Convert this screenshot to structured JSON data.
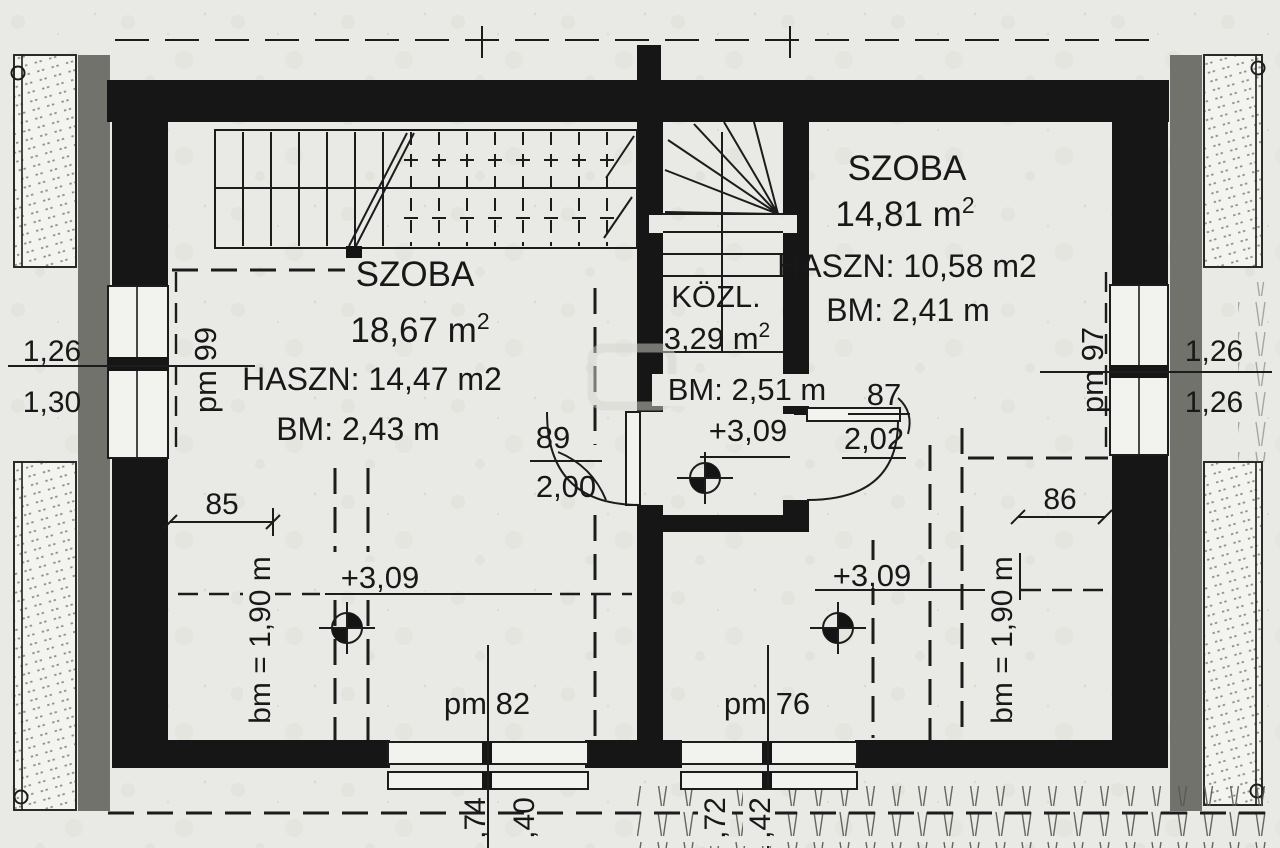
{
  "plan": {
    "left_room": {
      "name": "SZOBA",
      "area": "18,67 m",
      "area_sup": "2",
      "usable": "HASZN: 14,47 m2",
      "height": "BM: 2,43 m",
      "level_mark": "+3,09",
      "knee_line": "bm = 1,90 m",
      "opening_dim": "85",
      "door_width": "89",
      "door_height": "2,00",
      "window_bottom": "pm 82",
      "window_side": "pm 99",
      "eave_dim_a": ",74",
      "eave_dim_b": ",40",
      "facade_dim_top": "1,26",
      "facade_dim_bottom": "1,30"
    },
    "corridor": {
      "name": "KÖZL.",
      "area": "3,29 m",
      "area_sup": "2",
      "height": "BM: 2,51 m",
      "level_mark": "+3,09"
    },
    "right_room": {
      "name": "SZOBA",
      "area": "14,81 m",
      "area_sup": "2",
      "usable": "HASZN: 10,58 m2",
      "height": "BM: 2,41 m",
      "level_mark": "+3,09",
      "knee_line": "bm = 1,90 m",
      "opening_dim": "86",
      "door_width": "87",
      "door_height": "2,02",
      "window_bottom": "pm 76",
      "window_side": "pm 97",
      "eave_dim_a": ",72",
      "eave_dim_b": ",42",
      "facade_dim_top": "1,26",
      "facade_dim_bottom": "1,26"
    }
  }
}
